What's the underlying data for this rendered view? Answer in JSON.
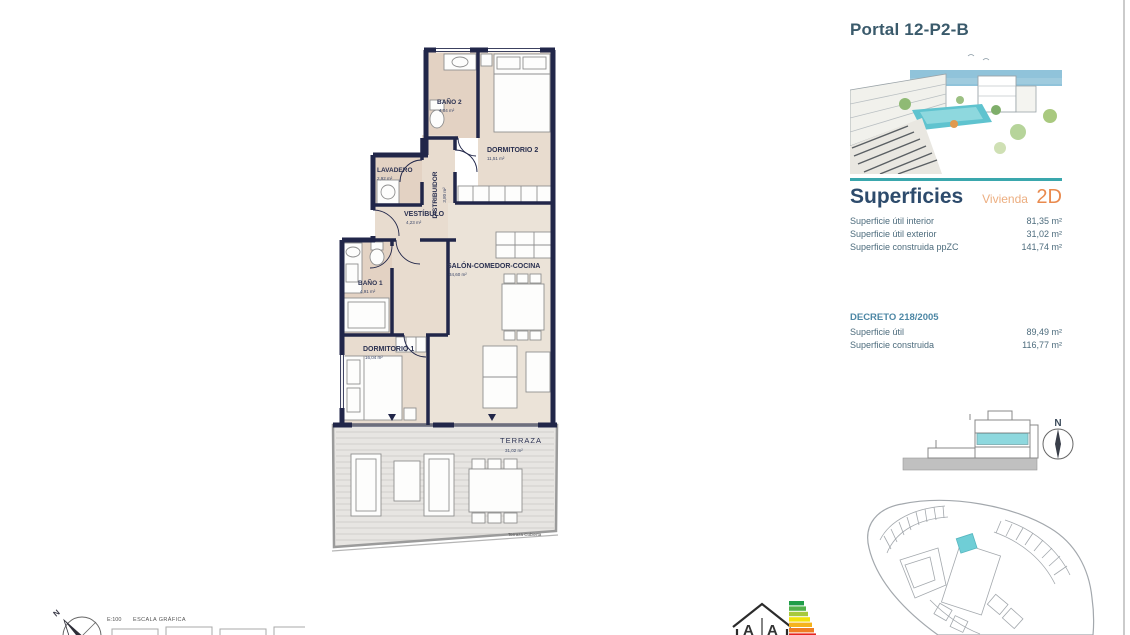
{
  "page": {
    "portal_title": "Portal 12-P2-B"
  },
  "panel": {
    "superficies_heading": "Superficies",
    "vivienda_label": "Vivienda",
    "vivienda_code": "2D",
    "rows": [
      {
        "label": "Superficie útil interior",
        "value": "81,35 m²"
      },
      {
        "label": "Superficie útil exterior",
        "value": "31,02 m²"
      },
      {
        "label": "Superficie construida ppZC",
        "value": "141,74 m²"
      }
    ],
    "decreto_heading": "DECRETO 218/2005",
    "decreto_rows": [
      {
        "label": "Superficie útil",
        "value": "89,49 m²"
      },
      {
        "label": "Superficie construida",
        "value": "116,77 m²"
      }
    ]
  },
  "plan": {
    "rooms": {
      "bano2": {
        "name": "BAÑO 2",
        "area": "4,04 m²"
      },
      "dormitorio2": {
        "name": "DORMITORIO 2",
        "area": "11,51 m²"
      },
      "lavadero": {
        "name": "LAVADERO",
        "area": "2,92 m²"
      },
      "distribuidor": {
        "name": "DISTRIBUIDOR",
        "area": "3,80 m²"
      },
      "vestibulo": {
        "name": "VESTÍBULO",
        "area": "4,23 m²"
      },
      "bano1": {
        "name": "BAÑO 1",
        "area": "4,91 m²"
      },
      "salon": {
        "name": "SALÓN-COMEDOR-COCINA",
        "area": "34,60 m²"
      },
      "dormitorio1": {
        "name": "DORMITORIO 1",
        "area": "16,04 m²"
      },
      "terraza": {
        "name": "TERRAZA",
        "area": "31,02 m²"
      }
    },
    "terraza_note": "Terraza Cubierta"
  },
  "footer": {
    "scale_ratio": "E:100",
    "scale_label": "ESCALA GRÁFICA",
    "north_label": "N"
  },
  "locator": {
    "north_label": "N"
  },
  "energy_label": {
    "letter_left": "A",
    "letter_right": "A"
  },
  "colors": {
    "teal": "#3aa7ad",
    "orange": "#e98a4e",
    "navy_wall": "#212649",
    "heading_blue": "#2d4b6c",
    "text_blue": "#4d6c7d",
    "highlight_cyan": "#8ed8de"
  }
}
